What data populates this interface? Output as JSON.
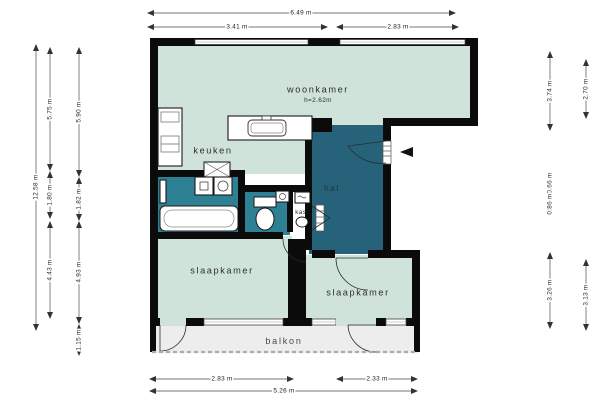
{
  "plan_type": "apartment-floorplan",
  "rooms": {
    "woonkamer": {
      "label": "woonkamer",
      "ceiling_height": "h=2.62m"
    },
    "keuken": {
      "label": "keuken"
    },
    "hal": {
      "label": "hal"
    },
    "kast": {
      "label": "kast"
    },
    "slaapkamer_left": {
      "label": "slaapkamer"
    },
    "slaapkamer_right": {
      "label": "slaapkamer"
    },
    "balkon": {
      "label": "balkon"
    }
  },
  "dimensions": {
    "top": {
      "total": "6.49 m",
      "left": "3.41 m",
      "right": "2.83 m"
    },
    "bottom": {
      "left": "2.83 m",
      "right": "2.33 m",
      "total": "5.26 m"
    },
    "left": {
      "total": "12.58 m",
      "outer_top": "5.75 m",
      "outer_mid": "1.80 m",
      "outer_bottom": "4.43 m",
      "inner_top": "5.90 m",
      "inner_mid": "1.82 m",
      "inner_bottom": "4.93 m",
      "balcony": "1.15 m"
    },
    "right": {
      "inner_top": "3.74 m",
      "outer_top": "2.70 m",
      "small_upper": "0.66 m",
      "small_lower": "0.86 m",
      "inner_bottom": "3.26 m",
      "outer_bottom": "3.13 m"
    }
  },
  "colors": {
    "room_fill": "#cfe3da",
    "bathroom_fill": "#2e8095",
    "hall_fill": "#26637b",
    "balcony_fill": "#ededed",
    "wall": "#0b0b0b"
  },
  "icons": {
    "entry_arrow": "left-filled-triangle",
    "fixtures": [
      "kitchen-counter",
      "kitchen-sink",
      "shaft-cross",
      "bathtub",
      "washer",
      "dryer",
      "radiator",
      "toilet",
      "hand-basin",
      "boiler",
      "closet-basin"
    ]
  }
}
